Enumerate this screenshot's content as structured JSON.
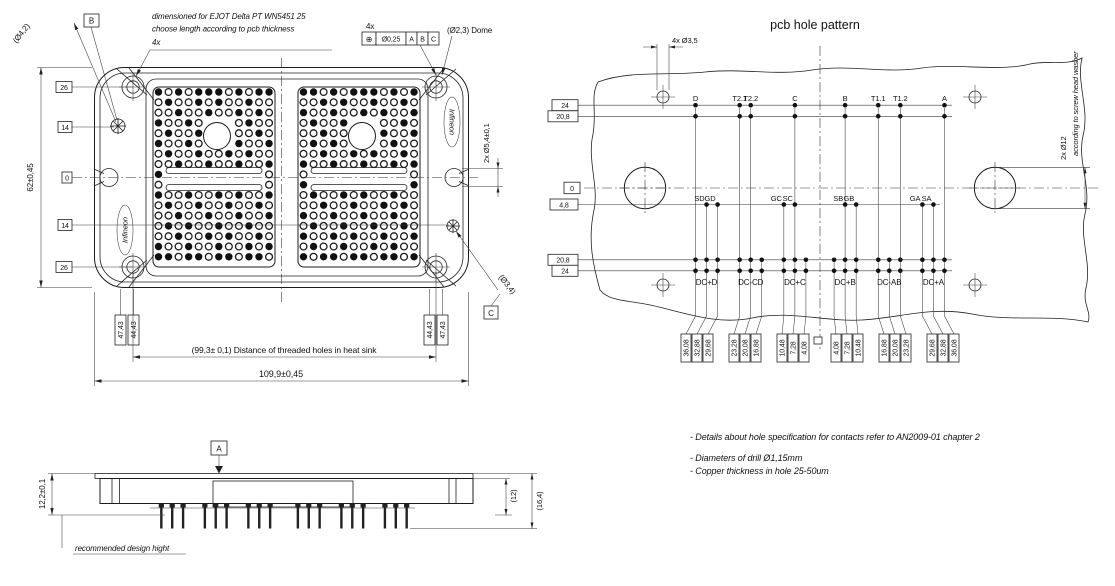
{
  "drawing": {
    "left_view": {
      "dia_hole_note": "(Ø4,2)",
      "datum_b": "B",
      "ejot_line1": "dimensioned for EJOT Delta PT WN5451 25",
      "ejot_line2": "choose length according to pcb thickness",
      "ejot_line3": "4x",
      "fcf_qty": "4x",
      "fcf_sym": "⊕",
      "fcf_tol": "Ø0,25",
      "fcf_d1": "A",
      "fcf_d2": "B",
      "fcf_d3": "C",
      "dome_note": "(Ø2,3) Dome",
      "notch_dim": "2x Ø5,4±0,1",
      "small_hole_note": "(Ø3,4)",
      "datum_c": "C",
      "height_dim": "62±0,45",
      "row_dims": [
        "26",
        "14",
        "0",
        "14",
        "26"
      ],
      "pin_col_dims": [
        "47,43",
        "44,43",
        "44,43",
        "47,43"
      ],
      "heatsink_dim": "(99,3± 0,1) Distance of threaded holes in heat sink",
      "width_dim": "109,9±0,45",
      "logo": "Infineon"
    },
    "side_view": {
      "datum_a": "A",
      "height_dim": "12,2±0,1",
      "ref_dim_12": "(12)",
      "ref_dim_164": "(16,4)",
      "note": "recommended design hight"
    },
    "right_view": {
      "title": "pcb hole pattern",
      "corner_hole_dim": "4x Ø3,5",
      "screw_clearance_dim": "2x Ø12",
      "screw_clearance_note": "according to screw head washer",
      "y_dim_top": [
        "24",
        "20,8"
      ],
      "y_zero": "0",
      "y_dim_gate": "4,8",
      "y_dim_bottom": [
        "20,8",
        "24"
      ],
      "top_pins": [
        {
          "label": "D",
          "mm": -36.08
        },
        {
          "label": "T2.1",
          "mm": -23.28
        },
        {
          "label": "T2.2",
          "mm": -20.08
        },
        {
          "label": "C",
          "mm": -7.28
        },
        {
          "label": "B",
          "mm": 7.28
        },
        {
          "label": "T1.1",
          "mm": 16.88
        },
        {
          "label": "T1.2",
          "mm": 23.28
        },
        {
          "label": "A",
          "mm": 36.08
        }
      ],
      "gate_pins": [
        {
          "label": "SD",
          "mm": -32.88
        },
        {
          "label": "GD",
          "mm": -29.68
        },
        {
          "label": "GC",
          "mm": -10.48
        },
        {
          "label": "SC",
          "mm": -7.28
        },
        {
          "label": "SB",
          "mm": 7.28
        },
        {
          "label": "GB",
          "mm": 10.48
        },
        {
          "label": "GA",
          "mm": 29.68
        },
        {
          "label": "SA",
          "mm": 32.88
        }
      ],
      "dc_groups": [
        {
          "label": "DC+D",
          "mm": -32.88
        },
        {
          "label": "DC-CD",
          "mm": -20.08
        },
        {
          "label": "DC+C",
          "mm": -7.28
        },
        {
          "label": "DC+B",
          "mm": 7.28
        },
        {
          "label": "DC-AB",
          "mm": 20.08
        },
        {
          "label": "DC+A",
          "mm": 32.88
        }
      ],
      "x_dim_values_mm": [
        4.08,
        7.28,
        10.48,
        16.88,
        20.08,
        23.28,
        29.68,
        32.88,
        36.08
      ],
      "x_dim_labels": [
        "4,08",
        "7,28",
        "10,48",
        "16,88",
        "20,08",
        "23,28",
        "29,68",
        "32,88",
        "36,08"
      ]
    },
    "notes": [
      "-  Details about hole specification for contacts refer to AN2009-01 chapter 2",
      "-  Diameters of drill Ø1,15mm",
      "-  Copper thickness in hole 25-50um"
    ]
  }
}
